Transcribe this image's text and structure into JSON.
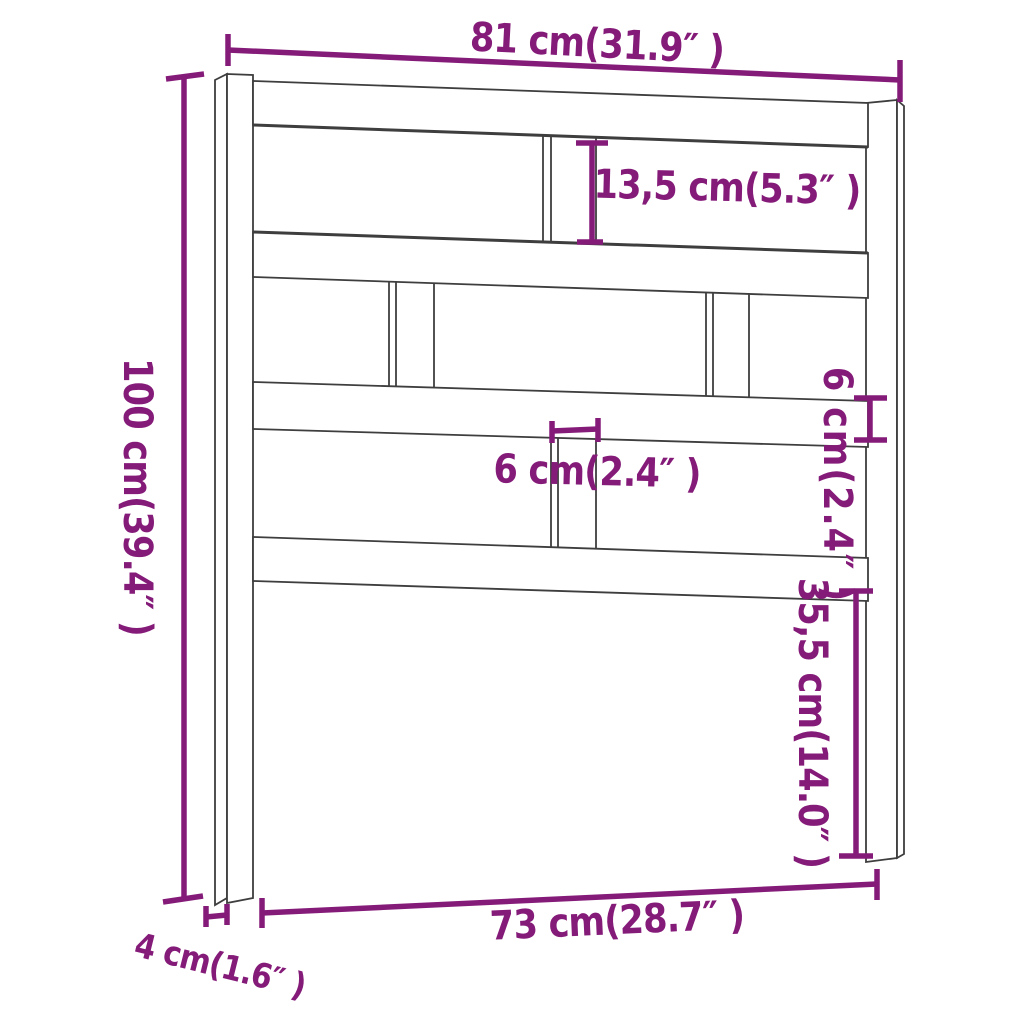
{
  "diagram": {
    "type": "product-dimension-diagram",
    "subject": "bed headboard line drawing",
    "background_color": "#FFFFFF",
    "outline_color": "#3E3E3E",
    "accent_color": "#851B79"
  },
  "labels": {
    "overall_width": "81 cm(31.9″ )",
    "upper_gap_height": "13,5 cm(5.3″ )",
    "overall_height": "100 cm(39.4″ )",
    "center_slat_width": "6 cm(2.4″ )",
    "rail_thickness": "6 cm(2.4″ )",
    "lower_clearance_height": "35,5 cm(14.0″ )",
    "inner_width": "73 cm(28.7″ )",
    "post_depth": "4 cm(1.6″ )"
  }
}
